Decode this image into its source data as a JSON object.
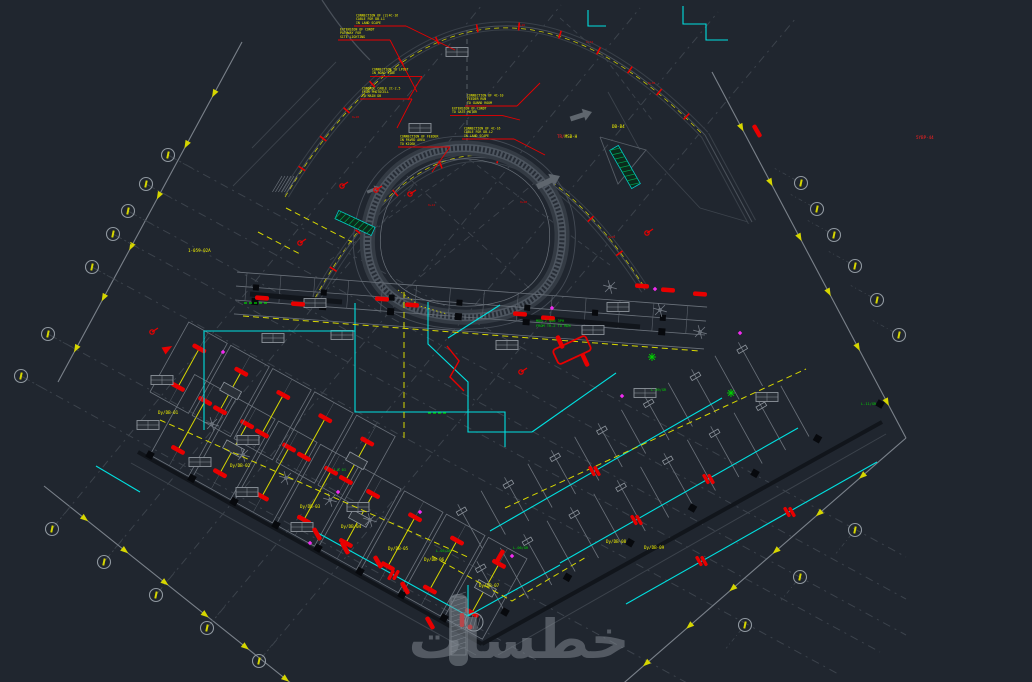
{
  "canvas": {
    "w": 1032,
    "h": 682,
    "bg": "#20262f"
  },
  "palette": {
    "faint": "#3c434c",
    "gray": "#6b727b",
    "gray_light": "#8d949c",
    "edge_dark": "#11151b",
    "column": "#07090d",
    "cyan": "#00e0e0",
    "yellow": "#f2f200",
    "yellow_dim": "#d8d800",
    "red": "#e80000",
    "red_bright": "#ff2020",
    "green": "#00d400",
    "magenta": "#f02bf0",
    "white": "#c8cdd3",
    "band": "#394049",
    "bubble": "#9098a0",
    "watermark": "#868d95"
  },
  "watermark": {
    "text": "خطسات",
    "x": 519,
    "y": 658,
    "size": 54,
    "opacity": 0.5,
    "bar": {
      "x": 449,
      "y": 594,
      "w": 19,
      "h": 72
    }
  },
  "boundaries": {
    "lines": [
      [
        242,
        42,
        58,
        382
      ],
      [
        44,
        486,
        312,
        700
      ],
      [
        712,
        72,
        906,
        438
      ],
      [
        906,
        438,
        618,
        688
      ]
    ],
    "arrow_fracs": [
      0.15,
      0.3,
      0.45,
      0.6,
      0.75,
      0.9
    ]
  },
  "grid": {
    "f1": [
      [
        168,
        155,
        906,
        557
      ],
      [
        146,
        184,
        906,
        599
      ],
      [
        128,
        211,
        906,
        635
      ],
      [
        113,
        234,
        880,
        652
      ],
      [
        92,
        267,
        840,
        675
      ],
      [
        48,
        334,
        700,
        690
      ],
      [
        21,
        376,
        540,
        662
      ]
    ],
    "f2": [
      [
        52,
        529,
        482,
        5
      ],
      [
        104,
        562,
        561,
        5
      ],
      [
        156,
        595,
        640,
        8
      ],
      [
        207,
        628,
        718,
        12
      ],
      [
        259,
        661,
        796,
        18
      ]
    ],
    "bubbles": [
      [
        168,
        155,
        29
      ],
      [
        146,
        184,
        29
      ],
      [
        128,
        211,
        29
      ],
      [
        113,
        234,
        29
      ],
      [
        92,
        267,
        29
      ],
      [
        48,
        334,
        29
      ],
      [
        21,
        376,
        29
      ],
      [
        52,
        529,
        -51
      ],
      [
        104,
        562,
        -51
      ],
      [
        156,
        595,
        -51
      ],
      [
        207,
        628,
        -51
      ],
      [
        259,
        661,
        -51
      ],
      [
        801,
        183,
        209
      ],
      [
        817,
        209,
        209
      ],
      [
        834,
        235,
        209
      ],
      [
        855,
        266,
        209
      ],
      [
        877,
        300,
        209
      ],
      [
        899,
        335,
        209
      ],
      [
        855,
        530,
        129
      ],
      [
        800,
        577,
        129
      ],
      [
        745,
        625,
        129
      ]
    ]
  },
  "roads": {
    "bands": [
      {
        "d": "M 285,195 Q 470,-110 705,135",
        "yoff": 2,
        "ticks": [
          0.06,
          0.13,
          0.2,
          0.27,
          0.34,
          0.42,
          0.5,
          0.58,
          0.66,
          0.74,
          0.81,
          0.88,
          0.95
        ]
      },
      {
        "d": "M 315,300 Q 470,20 645,290",
        "yoff": -2,
        "ticks": [
          0.08,
          0.18,
          0.3,
          0.42,
          0.55,
          0.68,
          0.8,
          0.9
        ]
      }
    ],
    "spur": [
      [
        705,
        135
      ],
      [
        752,
        222
      ]
    ],
    "extra_arcs": [
      "M 322,0 Q 344,34 370,60"
    ],
    "station_labels": [
      [
        518,
        26,
        "0+26"
      ],
      [
        586,
        43,
        "0+32"
      ],
      [
        648,
        84,
        "0+38"
      ],
      [
        428,
        206,
        "0+12"
      ],
      [
        520,
        203,
        "0+08"
      ],
      [
        608,
        238,
        "0+04"
      ],
      [
        352,
        118,
        "0+20"
      ]
    ]
  },
  "blob": {
    "d": "M 467,148 C 520,150 560,185 562,232 C 563,272 545,300 505,312 C 470,322 420,318 392,296 C 368,277 362,246 372,212 C 384,172 420,147 467,148 Z",
    "cx": 467,
    "cy": 232,
    "cross": [
      [
        398,
        168,
        540,
        298
      ],
      [
        543,
        176,
        392,
        300
      ]
    ],
    "center_dash": [
      467,
      30,
      467,
      148
    ]
  },
  "bandU": {
    "a": [
      235,
      300
    ],
    "b": [
      705,
      335
    ],
    "offsets": [
      28,
      14,
      0,
      -14
    ],
    "tick_step": 34,
    "tick_len": 28,
    "col_step": 68,
    "thick": [
      [
        250,
        294,
        342,
        302
      ],
      [
        518,
        316,
        640,
        327
      ]
    ]
  },
  "wings": {
    "rooms": [
      {
        "base": [
          150,
          455
        ],
        "angle": 29,
        "step": 48,
        "count": 8,
        "w": 44,
        "depth": 92
      },
      {
        "base": [
          150,
          392
        ],
        "angle": 29,
        "step": 48,
        "count": 5,
        "w": 44,
        "depth": 80
      }
    ],
    "stalls": [
      {
        "base": [
          505,
          612
        ],
        "angle": -30,
        "step": 27,
        "count": 14,
        "len": 58
      },
      {
        "base": [
          482,
          548
        ],
        "angle": -30,
        "step": 27,
        "count": 13,
        "len": 50
      }
    ],
    "edges": [
      [
        138,
        452,
        482,
        644
      ],
      [
        482,
        644,
        882,
        422
      ]
    ],
    "edge_shadow": [
      [
        131,
        463,
        476,
        655
      ],
      [
        498,
        655,
        886,
        434
      ]
    ],
    "edge_cols": [
      {
        "a": [
          150,
          455
        ],
        "b": [
          444,
          618
        ],
        "n": 8
      },
      {
        "a": [
          505,
          612
        ],
        "b": [
          880,
          404
        ],
        "n": 7
      }
    ]
  },
  "circuits": {
    "cyan": [
      [
        [
          683,
          6
        ],
        [
          683,
          24
        ],
        [
          706,
          24
        ],
        [
          706,
          40
        ],
        [
          728,
          40
        ]
      ],
      [
        [
          204,
          430
        ],
        [
          204,
          331
        ],
        [
          355,
          331
        ],
        [
          355,
          303
        ]
      ],
      [
        [
          355,
          331
        ],
        [
          355,
          412
        ],
        [
          505,
          412
        ],
        [
          505,
          447
        ]
      ],
      [
        [
          428,
          302
        ],
        [
          428,
          344
        ],
        [
          468,
          382
        ],
        [
          468,
          432
        ],
        [
          532,
          432
        ]
      ],
      [
        [
          532,
          432
        ],
        [
          616,
          373
        ]
      ],
      [
        [
          560,
          563
        ],
        [
          798,
          428
        ]
      ],
      [
        [
          626,
          604
        ],
        [
          877,
          462
        ]
      ],
      [
        [
          490,
          531
        ],
        [
          722,
          398
        ]
      ],
      [
        [
          318,
          533
        ],
        [
          468,
          616
        ],
        [
          560,
          565
        ]
      ],
      [
        [
          96,
          466
        ],
        [
          140,
          492
        ]
      ],
      [
        [
          588,
          10
        ],
        [
          588,
          26
        ],
        [
          606,
          26
        ]
      ],
      [
        [
          468,
          616
        ],
        [
          468,
          585
        ]
      ],
      [
        [
          448,
          338
        ],
        [
          500,
          305
        ]
      ]
    ],
    "yellow": [
      [
        [
          243,
          316
        ],
        [
          700,
          351
        ]
      ],
      [
        [
          160,
          420
        ],
        [
          470,
          558
        ]
      ],
      [
        [
          505,
          508
        ],
        [
          806,
          369
        ]
      ],
      [
        [
          404,
          292
        ],
        [
          404,
          442
        ]
      ],
      [
        [
          286,
          208
        ],
        [
          352,
          242
        ]
      ],
      [
        [
          432,
          556
        ],
        [
          512,
          601
        ],
        [
          588,
          556
        ]
      ],
      [
        [
          258,
          232
        ],
        [
          300,
          254
        ]
      ]
    ],
    "yellow_dots": [
      [
        398,
        290
      ],
      [
        420,
        306
      ],
      [
        447,
        314
      ]
    ],
    "dbl_ticks": [
      [
        636,
        520,
        60
      ],
      [
        708,
        479,
        60
      ],
      [
        701,
        561,
        60
      ],
      [
        789,
        512,
        60
      ],
      [
        594,
        471,
        60
      ],
      [
        393,
        575,
        -61
      ]
    ]
  },
  "fixtures": {
    "red_bars": [
      [
        262,
        298,
        4
      ],
      [
        298,
        304,
        4
      ],
      [
        382,
        299,
        4
      ],
      [
        412,
        305,
        4
      ],
      [
        520,
        314,
        4
      ],
      [
        548,
        318,
        4
      ],
      [
        642,
        286,
        4
      ],
      [
        668,
        290,
        4
      ],
      [
        700,
        294,
        4
      ],
      [
        757,
        131,
        60
      ],
      [
        405,
        588,
        60
      ],
      [
        500,
        556,
        -60
      ],
      [
        430,
        623,
        60
      ],
      [
        317,
        534,
        60
      ],
      [
        345,
        548,
        60
      ],
      [
        378,
        562,
        60
      ],
      [
        560,
        342,
        65
      ],
      [
        585,
        360,
        65
      ],
      [
        462,
        620,
        90
      ]
    ],
    "poles": [
      [
        342,
        186
      ],
      [
        376,
        190
      ],
      [
        410,
        194
      ],
      [
        300,
        243
      ],
      [
        647,
        233
      ],
      [
        521,
        372
      ],
      [
        152,
        332
      ]
    ],
    "red_circles": [
      [
        470,
        627
      ]
    ],
    "cluster_rect": [
      572,
      350,
      36,
      16,
      -25
    ],
    "zigzag": [
      [
        447,
        346
      ],
      [
        459,
        361
      ],
      [
        450,
        377
      ],
      [
        464,
        391
      ]
    ],
    "triangles": [
      [
        167,
        349,
        -30
      ]
    ]
  },
  "symbols": {
    "tables": [
      [
        457,
        52
      ],
      [
        420,
        128
      ],
      [
        162,
        380
      ],
      [
        273,
        338
      ],
      [
        315,
        303
      ],
      [
        342,
        335
      ],
      [
        618,
        307
      ],
      [
        593,
        330
      ],
      [
        507,
        345
      ],
      [
        767,
        397
      ],
      [
        148,
        425
      ],
      [
        200,
        462
      ],
      [
        248,
        440
      ],
      [
        247,
        492
      ],
      [
        302,
        527
      ],
      [
        358,
        507
      ],
      [
        645,
        393
      ]
    ],
    "trees": [
      [
        212,
        424
      ],
      [
        243,
        455
      ],
      [
        286,
        478
      ],
      [
        330,
        500
      ],
      [
        370,
        520
      ],
      [
        610,
        287
      ],
      [
        660,
        310
      ],
      [
        700,
        332
      ]
    ],
    "hatch_strips": [
      [
        625,
        167,
        44,
        10,
        60
      ],
      [
        355,
        223,
        40,
        9,
        25
      ]
    ],
    "hatch_patch": [
      282,
      176,
      18,
      16
    ],
    "manhole": [
      474,
      622,
      9
    ],
    "hatch_rect": [
      451,
      597,
      15,
      58
    ],
    "arrows_gray": [
      [
        560,
        176,
        -25,
        1.0
      ],
      [
        592,
        112,
        -18,
        0.9
      ],
      [
        380,
        187,
        -22,
        0.55
      ]
    ]
  },
  "labels": {
    "mixed": [
      {
        "x": 557,
        "y": 138,
        "parts": [
          [
            "TR/",
            "red"
          ],
          [
            "MSB-H",
            "yellow"
          ]
        ]
      },
      {
        "x": 612,
        "y": 128,
        "parts": [
          [
            "DB-B4",
            "yellow"
          ]
        ]
      },
      {
        "x": 916,
        "y": 139,
        "parts": [
          [
            "5YBP-44",
            "red"
          ]
        ]
      },
      {
        "x": 188,
        "y": 252,
        "parts": [
          [
            "1-059-02A",
            "yellow"
          ]
        ]
      },
      {
        "x": 300,
        "y": 508,
        "parts": [
          [
            "Dy/DB-03",
            "yellow"
          ]
        ]
      },
      {
        "x": 341,
        "y": 528,
        "parts": [
          [
            "Dy/DB-04",
            "yellow"
          ]
        ]
      },
      {
        "x": 388,
        "y": 550,
        "parts": [
          [
            "Dy/DB-05",
            "yellow"
          ]
        ]
      },
      {
        "x": 424,
        "y": 561,
        "parts": [
          [
            "Dy/DB-06",
            "yellow"
          ]
        ]
      },
      {
        "x": 479,
        "y": 587,
        "parts": [
          [
            "Dy/DB-07",
            "yellow"
          ]
        ]
      },
      {
        "x": 606,
        "y": 543,
        "parts": [
          [
            "Dy/DB-08",
            "yellow"
          ]
        ]
      },
      {
        "x": 644,
        "y": 549,
        "parts": [
          [
            "Dy/DB-09",
            "yellow"
          ]
        ]
      },
      {
        "x": 158,
        "y": 414,
        "parts": [
          [
            "Dy/DB-01",
            "yellow"
          ]
        ]
      },
      {
        "x": 230,
        "y": 467,
        "parts": [
          [
            "Dy/DB-02",
            "yellow"
          ]
        ]
      }
    ],
    "green": [
      [
        536,
        322,
        "MDB 2 RUN 3PH"
      ],
      [
        536,
        327,
        "FROM TR-2 TO MDB"
      ],
      [
        436,
        552,
        "L-05/GR"
      ],
      [
        513,
        549,
        "L-06/GR"
      ],
      [
        333,
        471,
        "J-B 01"
      ],
      [
        651,
        391,
        "L-09/GR"
      ],
      [
        861,
        405,
        "L-11/GR"
      ]
    ],
    "green_marks": [
      [
        244,
        303,
        267,
        303
      ],
      [
        428,
        413,
        448,
        413
      ]
    ],
    "green_stars": [
      [
        731,
        393
      ],
      [
        652,
        357
      ]
    ],
    "magenta": [
      [
        552,
        308
      ],
      [
        655,
        289
      ],
      [
        740,
        333
      ],
      [
        223,
        352
      ],
      [
        420,
        512
      ],
      [
        512,
        556
      ],
      [
        622,
        396
      ],
      [
        310,
        543
      ],
      [
        338,
        492
      ]
    ]
  },
  "notes": [
    {
      "x": 356,
      "y": 14,
      "lines": [
        "CONNECTION OF (2)4C-16",
        "CABLE FOR DB-L1",
        "IN LAND SCAPE"
      ],
      "t": [
        455,
        50
      ]
    },
    {
      "x": 340,
      "y": 28,
      "lines": [
        "EXTENSION OF CONDT",
        "PATHWAY FOR",
        "SITE LIGHTING"
      ],
      "t": [
        417,
        92
      ]
    },
    {
      "x": 372,
      "y": 68,
      "lines": [
        "CONNECTION TO LPOST",
        "IN ROAD SIDE"
      ],
      "t": [
        408,
        100
      ]
    },
    {
      "x": 362,
      "y": 87,
      "lines": [
        "CONTROL CABLE 2C-2.5",
        "FROM PHOTOCELL",
        "TO MAIN DB"
      ],
      "t": [
        397,
        128
      ]
    },
    {
      "x": 467,
      "y": 94,
      "lines": [
        "CONNECTION OF 4C-10",
        "FEEDER RUN",
        "TO GUARD ROOM"
      ],
      "t": [
        540,
        83
      ]
    },
    {
      "x": 452,
      "y": 107,
      "lines": [
        "EXTENSION OF CONDT",
        "TO GATE MOTOR"
      ],
      "t": [
        520,
        120
      ]
    },
    {
      "x": 464,
      "y": 127,
      "lines": [
        "CONNECTION OF 4C-16",
        "CABLE FOR DB-L2",
        "IN LAND SCAPE"
      ],
      "t": [
        545,
        155
      ]
    },
    {
      "x": 400,
      "y": 135,
      "lines": [
        "CONNECTION OF FEEDER",
        "IN PAVED AREA",
        "TO KIOSK"
      ],
      "t": [
        432,
        172
      ]
    }
  ],
  "faint": {
    "lines": [
      {
        "p": [
          252,
          148,
          336,
          62
        ],
        "dash": false
      },
      {
        "p": [
          233,
          186,
          320,
          98
        ],
        "dash": false
      },
      {
        "p": [
          608,
          92,
          640,
          150
        ],
        "dash": false
      },
      {
        "p": [
          646,
          150,
          700,
          208
        ],
        "dash": false
      },
      {
        "p": [
          700,
          208,
          748,
          222
        ],
        "dash": false
      },
      {
        "p": [
          560,
          18,
          605,
          58
        ],
        "dash": true
      },
      {
        "p": [
          605,
          58,
          652,
          120
        ],
        "dash": true
      },
      {
        "p": [
          330,
          260,
          470,
          160
        ],
        "dash": true
      },
      {
        "p": [
          470,
          160,
          610,
          265
        ],
        "dash": true
      }
    ],
    "polys": [
      [
        [
          600,
          137
        ],
        [
          646,
          150
        ],
        [
          618,
          184
        ],
        [
          600,
          137
        ]
      ]
    ]
  }
}
